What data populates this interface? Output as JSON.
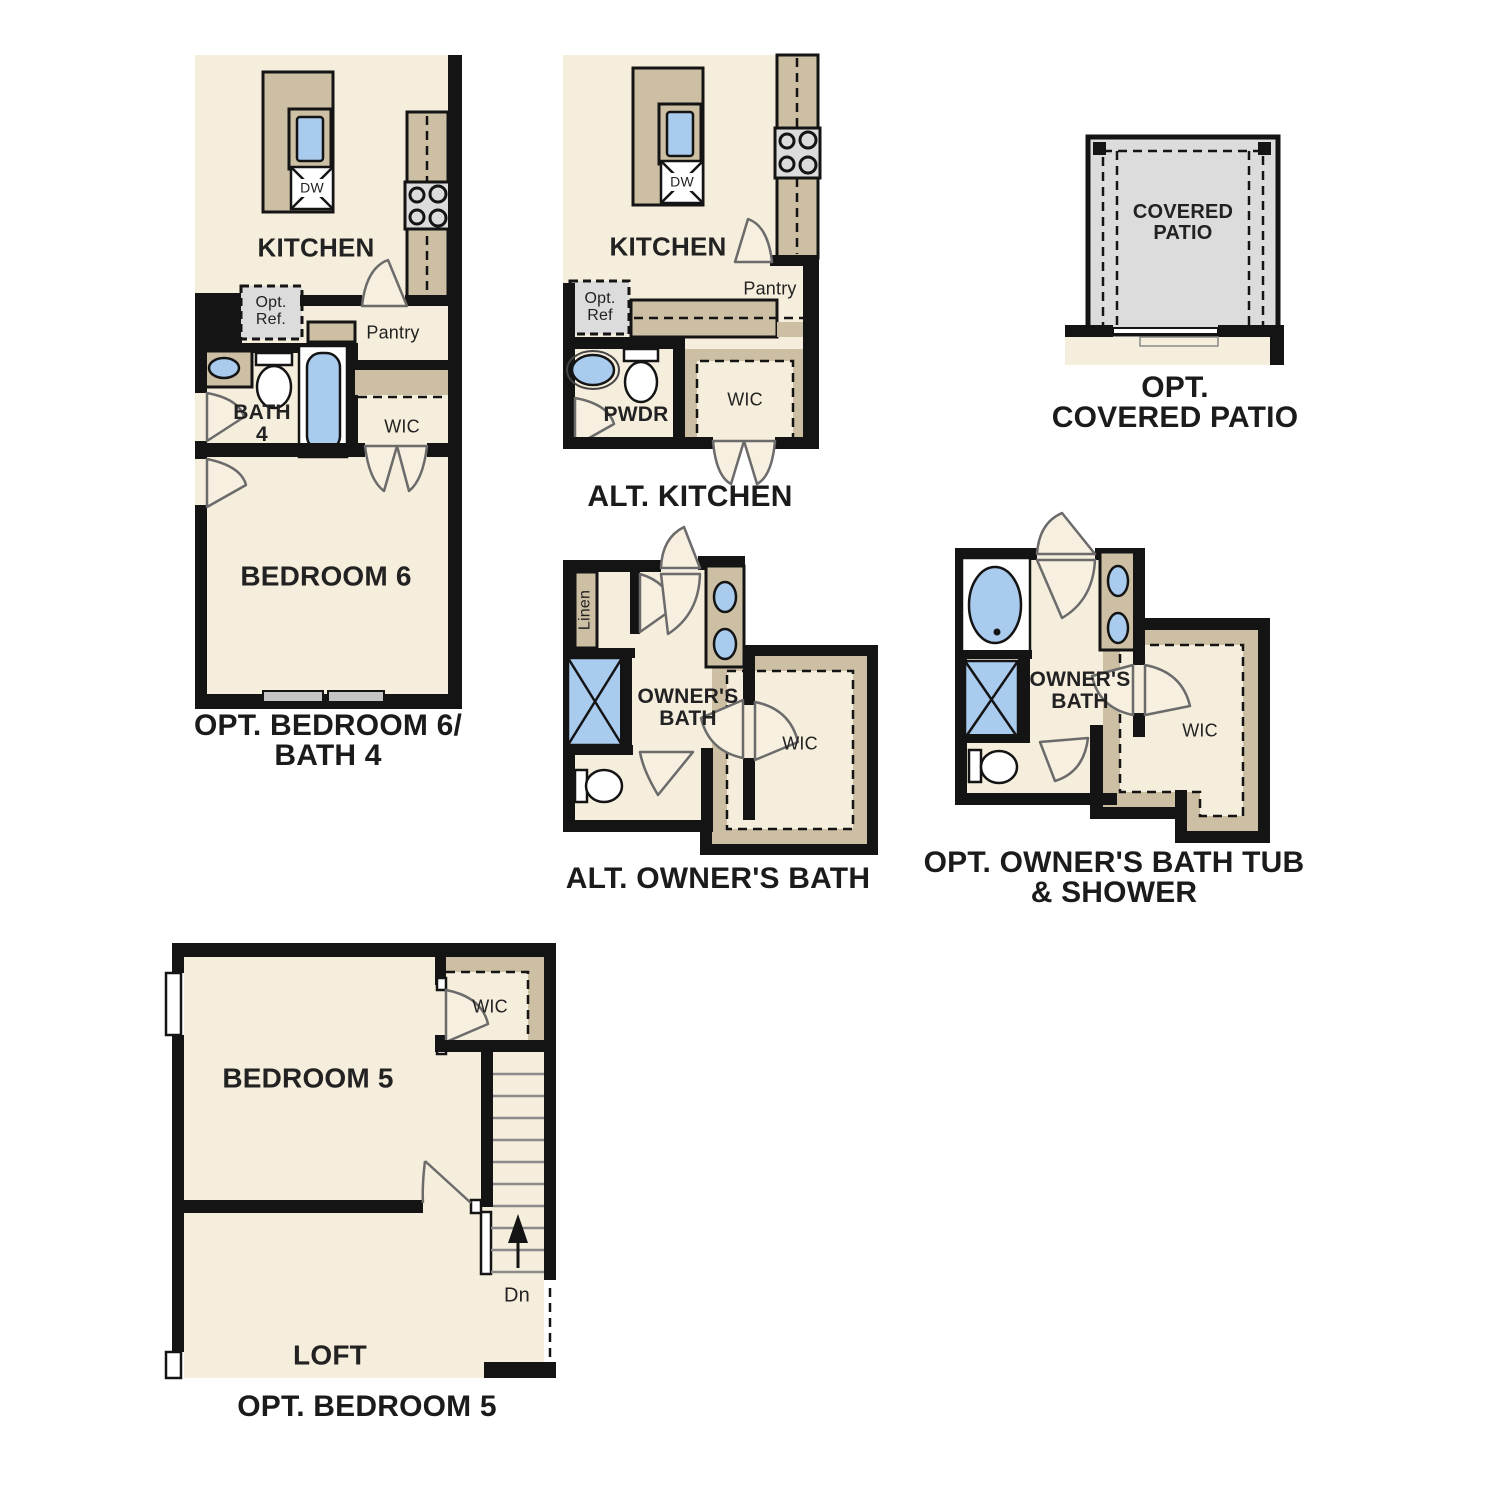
{
  "palette": {
    "floor": "#f6eedd",
    "counter_tan": "#cdbfa3",
    "fixture_blue": "#a9cbee",
    "patio_gray": "#dcdcdc",
    "wall_black": "#141414",
    "label_color": "#222222"
  },
  "plans": {
    "p1": {
      "caption": "OPT. BEDROOM 6/\nBATH 4",
      "kitchen": "KITCHEN",
      "dw": "DW",
      "opt_ref": "Opt.\nRef.",
      "pantry": "Pantry",
      "bath": "BATH\n4",
      "wic": "WIC",
      "bedroom": "BEDROOM 6"
    },
    "p2": {
      "caption": "ALT. KITCHEN",
      "kitchen": "KITCHEN",
      "dw": "DW",
      "opt_ref": "Opt.\nRef",
      "pantry": "Pantry",
      "pwdr": "PWDR",
      "wic": "WIC"
    },
    "p3": {
      "caption": "OPT.\nCOVERED PATIO",
      "room": "COVERED\nPATIO"
    },
    "p4": {
      "caption": "ALT. OWNER'S BATH",
      "room": "OWNER'S\nBATH",
      "linen": "Linen",
      "wic": "WIC"
    },
    "p5": {
      "caption": "OPT. OWNER'S BATH TUB\n& SHOWER",
      "room": "OWNER'S\nBATH",
      "wic": "WIC"
    },
    "p6": {
      "caption": "OPT. BEDROOM 5",
      "bedroom": "BEDROOM 5",
      "wic": "WIC",
      "loft": "LOFT",
      "dn": "Dn"
    }
  }
}
